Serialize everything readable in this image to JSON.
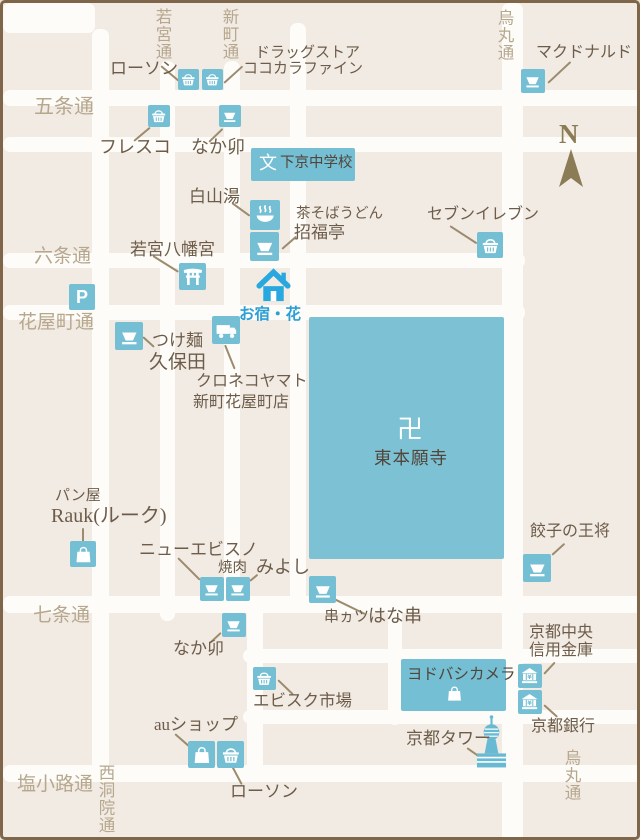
{
  "colors": {
    "background": "#f2ebe4",
    "road_white": "#fdfcf8",
    "poi_blue": "#74bfd4",
    "temple_blue": "#7cc2d4",
    "house_blue": "#29a8e0",
    "yado_text_blue": "#2b9fd6",
    "label_brown": "#6d5c49",
    "street_label_tan": "#b6a78d",
    "text_on_blue": "#52453a",
    "connector_tan": "#9c8b6d",
    "border_brown": "#7f6549",
    "compass_tan": "#8c7c55"
  },
  "compass": {
    "north_label": "N"
  },
  "icons": {
    "bank_yen_symbol": "¥"
  },
  "streets": {
    "gojo_dori": "五条通",
    "rokujo_dori": "六条通",
    "hanayacho_dori": "花屋町通",
    "shichijo_dori": "七条通",
    "shiokoji_dori": "塩小路通",
    "wakamiya_dori": "若宮通",
    "shinmachi_dori": "新町通",
    "karasuma_dori_top": "烏丸通",
    "karasuma_dori_bottom": "烏丸通",
    "nishinotoin_dori": "西洞院通"
  },
  "pois": {
    "lawson_top": {
      "label": "ローソン"
    },
    "cocokara_fine": {
      "label_line1": "ドラッグストア",
      "label_line2": "ココカラファイン"
    },
    "mcdonalds": {
      "label": "マクドナルド"
    },
    "fresco": {
      "label": "フレスコ"
    },
    "nakau_north": {
      "label": "なか卯"
    },
    "shimogyo_junior_high": {
      "symbol": "文",
      "label": "下京中学校"
    },
    "hakusanyu": {
      "label": "白山湯"
    },
    "shofukutei": {
      "label_line1": "茶そばうどん",
      "label_line2": "招福亭"
    },
    "seven_eleven": {
      "label": "セブンイレブン"
    },
    "wakamiya_hachimangu": {
      "label": "若宮八幡宮"
    },
    "parking": {
      "symbol": "P"
    },
    "tsukemen_kubota": {
      "label_line1": "つけ麺",
      "label_line2": "久保田"
    },
    "oyado_hana": {
      "label": "お宿・花"
    },
    "kuroneko_yamato": {
      "label_line1": "クロネコヤマト",
      "label_line2": "新町花屋町店"
    },
    "higashi_honganji": {
      "symbol": "卍",
      "label": "東本願寺"
    },
    "bakery_rauk": {
      "label_line1": "パン屋",
      "label_line2": "Rauk(ルーク)"
    },
    "new_ebisuno": {
      "label": "ニューエビスノ"
    },
    "yakiniku_miyoshi": {
      "label_line1": "焼肉",
      "label_line2": "みよし"
    },
    "kushikatsu_hanakushi": {
      "label_line1": "串ヵツ",
      "label_line2": "はな串"
    },
    "gyoza_no_ohsho": {
      "label": "餃子の王将"
    },
    "nakau_south": {
      "label": "なか卯"
    },
    "ebisuku_ichiba": {
      "label": "エビスク市場"
    },
    "au_shop": {
      "label": "auショップ"
    },
    "lawson_south": {
      "label": "ローソン"
    },
    "yodobashi_camera": {
      "label": "ヨドバシカメラ"
    },
    "kyoto_chuo_shinkin": {
      "label_line1": "京都中央",
      "label_line2": "信用金庫"
    },
    "kyoto_bank": {
      "label": "京都銀行"
    },
    "kyoto_tower": {
      "label": "京都タワー"
    }
  }
}
